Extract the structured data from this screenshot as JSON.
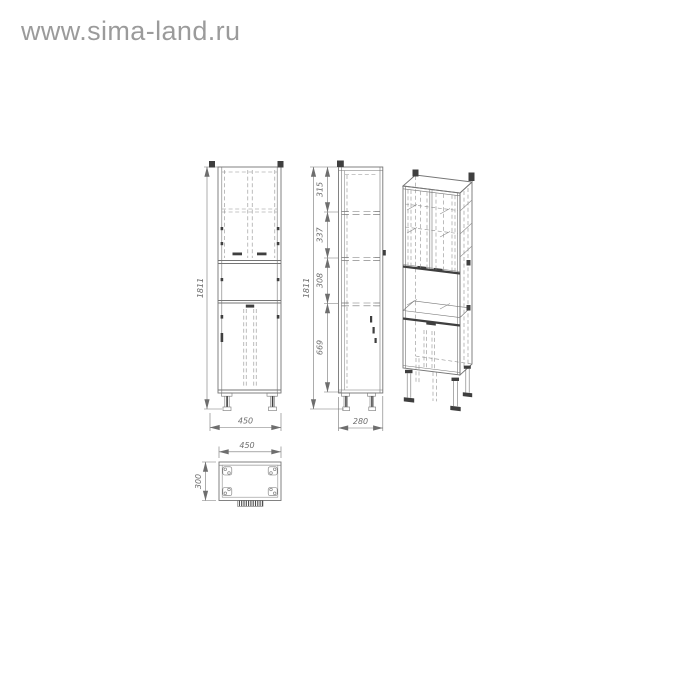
{
  "watermark": {
    "text": "www.sima-land.ru"
  },
  "drawing_title": "tall cabinet dimensioned technical drawing",
  "dims": {
    "front_height": "1811",
    "front_width": "450",
    "side_height": "1811",
    "side_seg_top": "315",
    "side_seg_2": "337",
    "side_seg_3": "308",
    "side_seg_bottom": "669",
    "side_depth": "280",
    "plan_width": "450",
    "plan_depth": "300"
  },
  "views": {
    "front": "front elevation view",
    "side": "side section view",
    "iso": "isometric 3d view",
    "top": "top plan view"
  },
  "colors": {
    "background": "#ffffff",
    "line": "#757575",
    "line_light": "#8f8f8f",
    "accent_dark": "#3f3f3f",
    "dimension_text": "#6e6e6e",
    "watermark": "#9b9b9b"
  }
}
